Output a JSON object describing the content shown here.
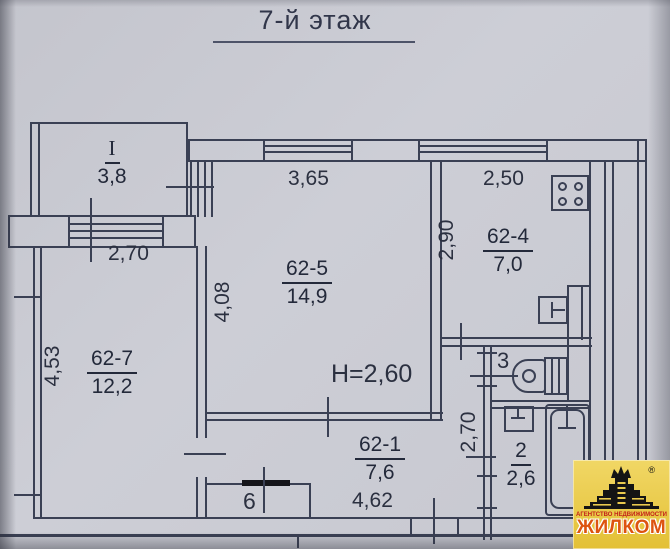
{
  "title": "7-й этаж",
  "rooms": {
    "balcony": {
      "id": "I",
      "area": "3,8"
    },
    "living": {
      "id": "62-5",
      "area": "14,9"
    },
    "kitchen": {
      "id": "62-4",
      "area": "7,0"
    },
    "bedroom": {
      "id": "62-7",
      "area": "12,2"
    },
    "hallway": {
      "id": "62-1",
      "area": "7,6"
    },
    "bathroom": {
      "id": "2",
      "area": "2,6"
    },
    "toilet": {
      "id": "3"
    },
    "closet": {
      "id": "6"
    }
  },
  "dimensions": {
    "bedroom_width": "2,70",
    "bedroom_depth": "4,53",
    "living_width": "3,65",
    "living_depth": "4,08",
    "kitchen_width": "2,50",
    "kitchen_depth": "2,90",
    "hallway_length": "4,62",
    "bathroom_depth": "2,70",
    "ceiling_height": "Н=2,60"
  },
  "logo": {
    "agency_line": "АГЕНТСТВО НЕДВИЖИМОСТИ",
    "brand": "ЖИЛКОМ",
    "registered_mark": "®"
  }
}
